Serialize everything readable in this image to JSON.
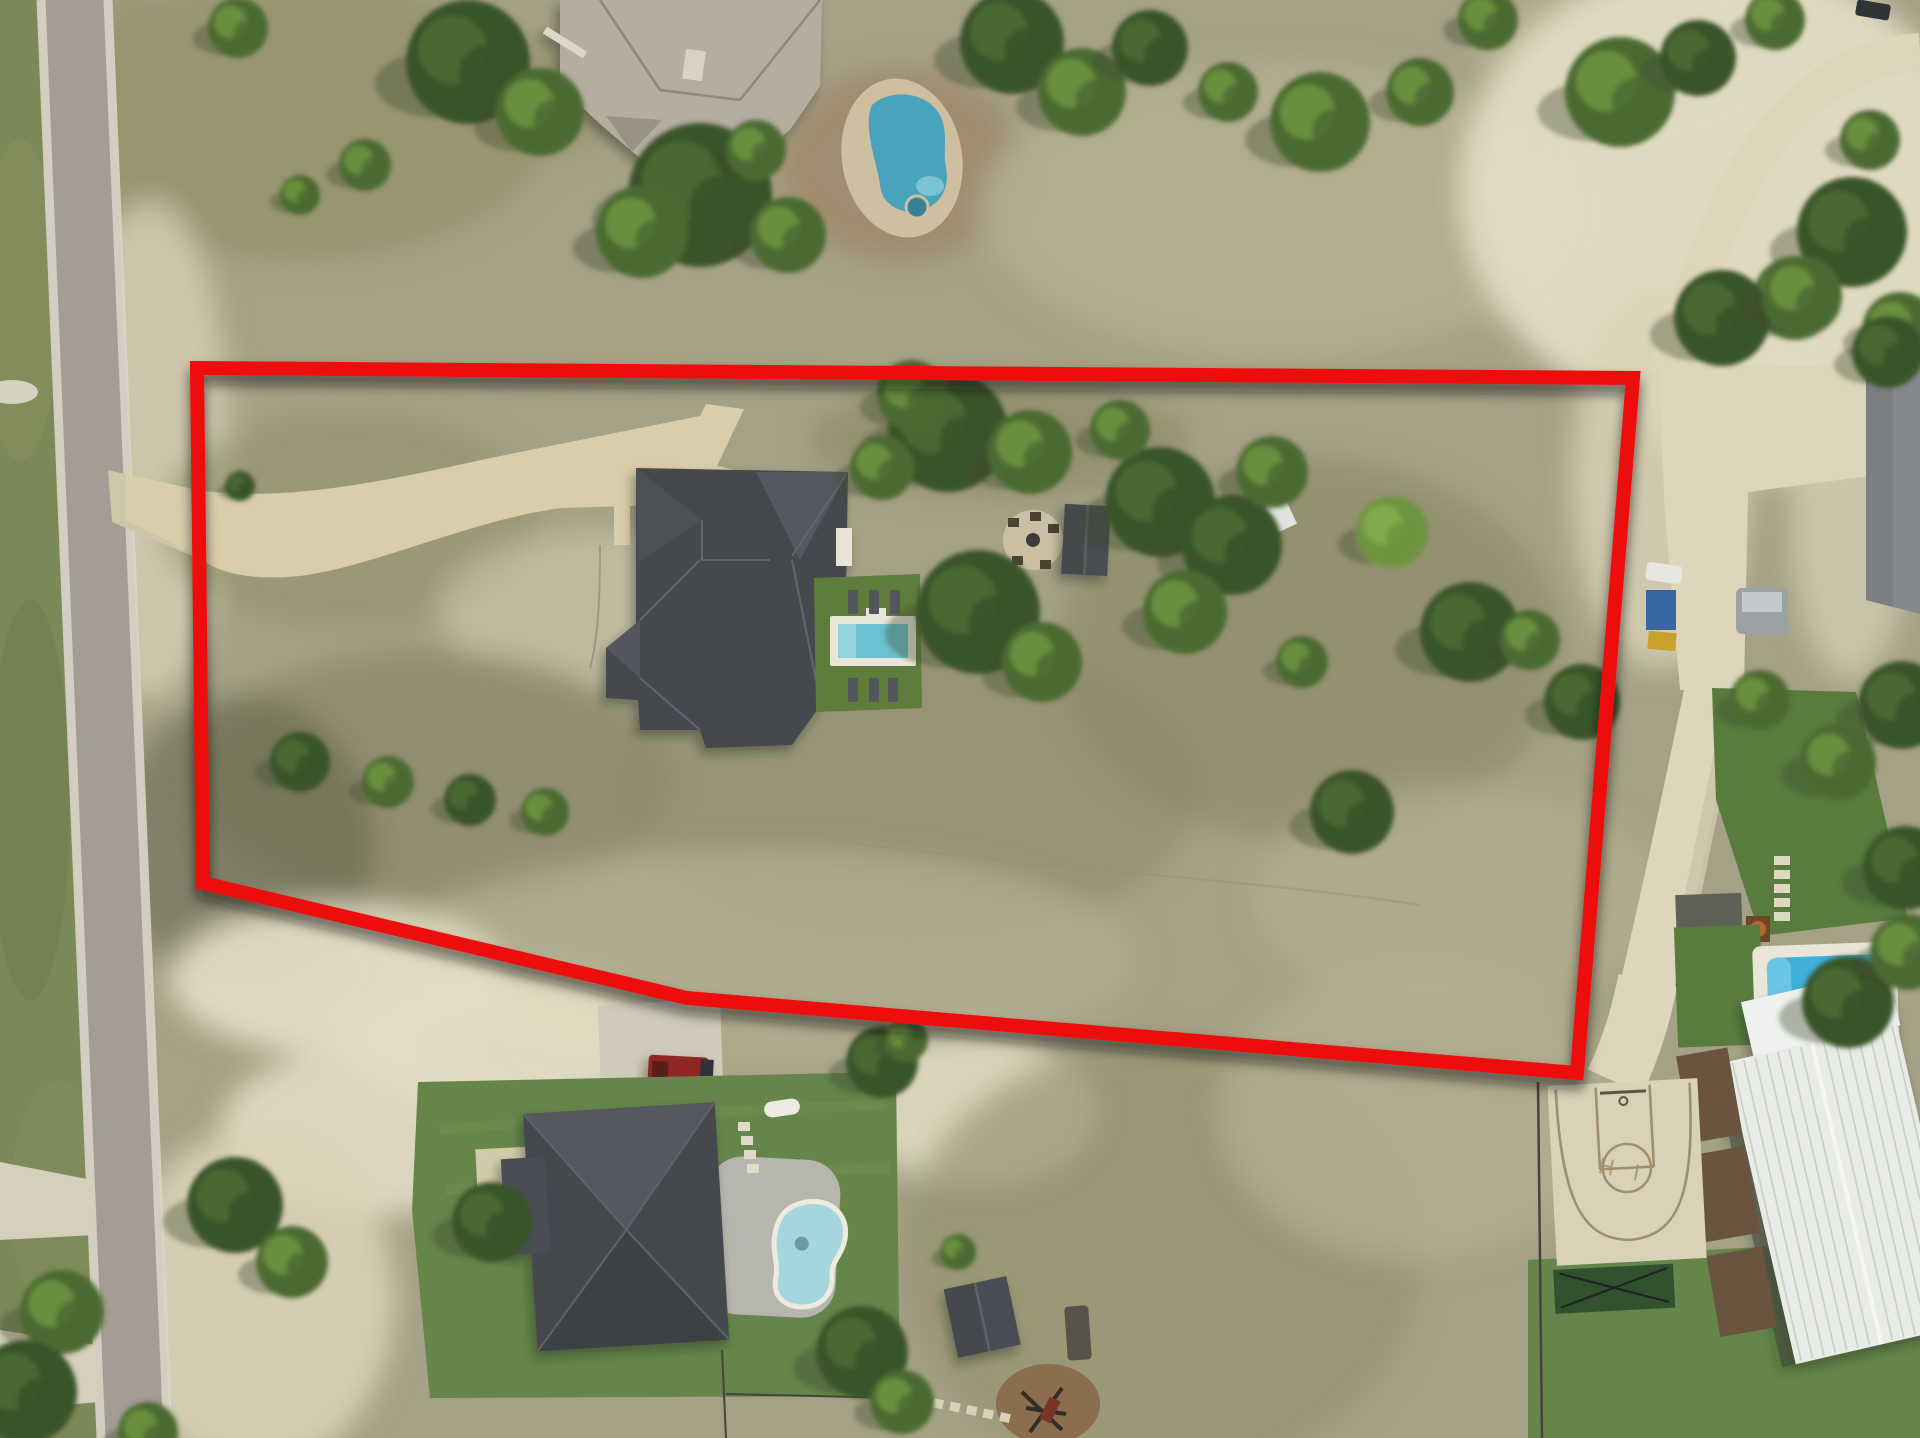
{
  "meta": {
    "description": "Drone aerial photograph of a rural residential lot with a red property-boundary outline drawn over the land",
    "photo_type": "top-down aerial"
  },
  "boundary": {
    "color": "#ee1010",
    "stroke_width": 14,
    "points": "197,368 1633,378 1577,1073 687,998 203,883"
  },
  "court": {
    "marking": "H I"
  },
  "palette": {
    "field_base": "#a5a186",
    "field_olive": "#8d8a6a",
    "field_pale": "#b3ae90",
    "field_green": "#97946f",
    "shade_olive": "#5e6049",
    "caliche": "#d9d2b8",
    "caliche_bright": "#e3dcc4",
    "grass_west": "#7b8857",
    "lawn_green": "#5e7c3b",
    "lawn_bottom": "#66854a",
    "lawn_right": "#587b3e",
    "turf_dark": "#31512f",
    "road_asphalt": "#a39d94",
    "road_edge": "#d9d4c7",
    "concrete_light": "#ded6ba",
    "driveway": "#d9cdaa",
    "driveway_entry": "#cfc6a8",
    "pad_concrete": "#cfcaba",
    "roof_dark": "#45484e",
    "roof_dark_hi": "#54585e",
    "roof_dark_lo": "#3d4045",
    "roof_top_house": "#b4ada0",
    "roof_top_house_lo": "#9a9285",
    "roof_right_house": "#85888c",
    "building_white": "#e9ebe7",
    "building_rib": "#c6cac4",
    "deck_brown": "#6a543f",
    "deck_gray": "#b6b6ae",
    "pool_deck": "#e9e6d7",
    "pool_center": "#6ac2d2",
    "pool_center_steps": "#93d3dc",
    "pool_top": "#4aa3bd",
    "pool_bottom": "#a5d6dd",
    "pool_right": "#3fb0dc",
    "dirt_brown": "#a08a6b",
    "mulch": "#8a6e4d",
    "tree_dark": "#3a5429",
    "tree_mid": "#4c6b33",
    "tree_light": "#6e9440",
    "tree_extra": "#86ad4f",
    "tree_shadow": "#3f4a33",
    "truck_red": "#8f2723",
    "court_concrete": "#d9d2b7",
    "court_line": "#a08e6d",
    "white_obj": "#eceae2",
    "fence": "#45443a"
  },
  "scene": {
    "building_rib_count": 15,
    "ground_patches": [
      [
        300,
        120,
        250,
        140,
        "field_green",
        0.9
      ],
      [
        545,
        95,
        80,
        60,
        "field_green",
        0.8
      ],
      [
        120,
        60,
        70,
        80,
        "field_green",
        0.6
      ],
      [
        900,
        165,
        120,
        95,
        "dirt_brown",
        0.9
      ],
      [
        1280,
        210,
        300,
        150,
        "field_pale",
        0.9
      ],
      [
        1635,
        60,
        160,
        90,
        "field_pale",
        0.8
      ],
      [
        1720,
        190,
        260,
        230,
        "caliche_bright",
        0.95
      ],
      [
        1760,
        420,
        120,
        60,
        "caliche_bright",
        0.8
      ],
      [
        1660,
        480,
        90,
        190,
        "caliche",
        0.8
      ],
      [
        1850,
        520,
        60,
        160,
        "caliche",
        0.7
      ],
      [
        150,
        450,
        80,
        250,
        "caliche",
        0.75
      ],
      [
        350,
        520,
        190,
        110,
        "field_green",
        0.7
      ],
      [
        610,
        610,
        170,
        80,
        "caliche",
        0.5
      ],
      [
        1000,
        440,
        190,
        55,
        "field_olive",
        0.7
      ],
      [
        430,
        780,
        240,
        130,
        "field_olive",
        0.8
      ],
      [
        910,
        790,
        290,
        150,
        "field_olive",
        0.6
      ],
      [
        1310,
        650,
        250,
        190,
        "field_olive",
        0.7
      ],
      [
        1460,
        900,
        210,
        115,
        "field_pale",
        0.7
      ],
      [
        760,
        960,
        380,
        110,
        "field_pale",
        0.75
      ],
      [
        245,
        845,
        130,
        150,
        "shade_olive",
        0.5
      ],
      [
        340,
        980,
        170,
        75,
        "caliche_bright",
        0.95
      ],
      [
        500,
        1040,
        160,
        70,
        "caliche_bright",
        0.95
      ],
      [
        380,
        1130,
        160,
        85,
        "caliche_bright",
        0.9
      ],
      [
        255,
        1300,
        140,
        170,
        "caliche",
        0.9
      ],
      [
        975,
        1110,
        120,
        75,
        "caliche_bright",
        0.85
      ],
      [
        1160,
        1260,
        260,
        220,
        "field_green",
        0.7
      ],
      [
        1420,
        1110,
        200,
        150,
        "field_pale",
        0.8
      ]
    ],
    "trees": [
      [
        468,
        62,
        62,
        0
      ],
      [
        540,
        112,
        44,
        1
      ],
      [
        365,
        165,
        26,
        1
      ],
      [
        300,
        195,
        20,
        1
      ],
      [
        238,
        28,
        30,
        1
      ],
      [
        700,
        195,
        72,
        0
      ],
      [
        642,
        232,
        46,
        1
      ],
      [
        788,
        235,
        38,
        1
      ],
      [
        756,
        150,
        30,
        1
      ],
      [
        1012,
        42,
        52,
        0
      ],
      [
        1082,
        92,
        44,
        1
      ],
      [
        1150,
        48,
        38,
        0
      ],
      [
        1228,
        92,
        30,
        1
      ],
      [
        1320,
        122,
        50,
        1
      ],
      [
        1420,
        92,
        34,
        1
      ],
      [
        1488,
        20,
        30,
        1
      ],
      [
        1620,
        92,
        55,
        1
      ],
      [
        1698,
        58,
        38,
        0
      ],
      [
        1775,
        20,
        30,
        1
      ],
      [
        1852,
        232,
        55,
        0
      ],
      [
        1795,
        298,
        42,
        1
      ],
      [
        1900,
        330,
        38,
        1
      ],
      [
        1870,
        140,
        30,
        1
      ],
      [
        1722,
        318,
        48,
        0
      ],
      [
        1802,
        296,
        40,
        1
      ],
      [
        1888,
        352,
        36,
        0
      ],
      [
        1902,
        705,
        44,
        0
      ],
      [
        1838,
        762,
        38,
        1
      ],
      [
        1905,
        868,
        42,
        0
      ],
      [
        1760,
        700,
        30,
        1
      ],
      [
        240,
        486,
        15,
        0
      ],
      [
        948,
        432,
        60,
        0
      ],
      [
        1030,
        452,
        42,
        1
      ],
      [
        882,
        468,
        32,
        1
      ],
      [
        912,
        395,
        35,
        1
      ],
      [
        1160,
        502,
        55,
        0
      ],
      [
        1232,
        545,
        50,
        0
      ],
      [
        1185,
        612,
        42,
        1
      ],
      [
        1272,
        472,
        36,
        1
      ],
      [
        1120,
        430,
        30,
        1
      ],
      [
        978,
        612,
        62,
        0
      ],
      [
        1042,
        662,
        40,
        1
      ],
      [
        1392,
        532,
        36,
        2
      ],
      [
        1470,
        632,
        50,
        0
      ],
      [
        1302,
        662,
        26,
        1
      ],
      [
        1352,
        812,
        42,
        0
      ],
      [
        1582,
        702,
        38,
        0
      ],
      [
        1530,
        640,
        30,
        1
      ],
      [
        300,
        762,
        30,
        0
      ],
      [
        388,
        782,
        26,
        1
      ],
      [
        470,
        800,
        26,
        0
      ],
      [
        545,
        812,
        24,
        1
      ],
      [
        882,
        1062,
        36,
        0
      ],
      [
        906,
        1040,
        22,
        1
      ],
      [
        958,
        1252,
        18,
        1
      ],
      [
        235,
        1205,
        48,
        0
      ],
      [
        292,
        1262,
        36,
        1
      ],
      [
        492,
        1222,
        40,
        0
      ],
      [
        862,
        1352,
        46,
        0
      ],
      [
        902,
        1402,
        32,
        1
      ],
      [
        1848,
        1002,
        46,
        0
      ],
      [
        1908,
        952,
        38,
        1
      ],
      [
        62,
        1312,
        42,
        1
      ],
      [
        25,
        1392,
        52,
        0
      ],
      [
        148,
        1432,
        30,
        1
      ]
    ]
  }
}
